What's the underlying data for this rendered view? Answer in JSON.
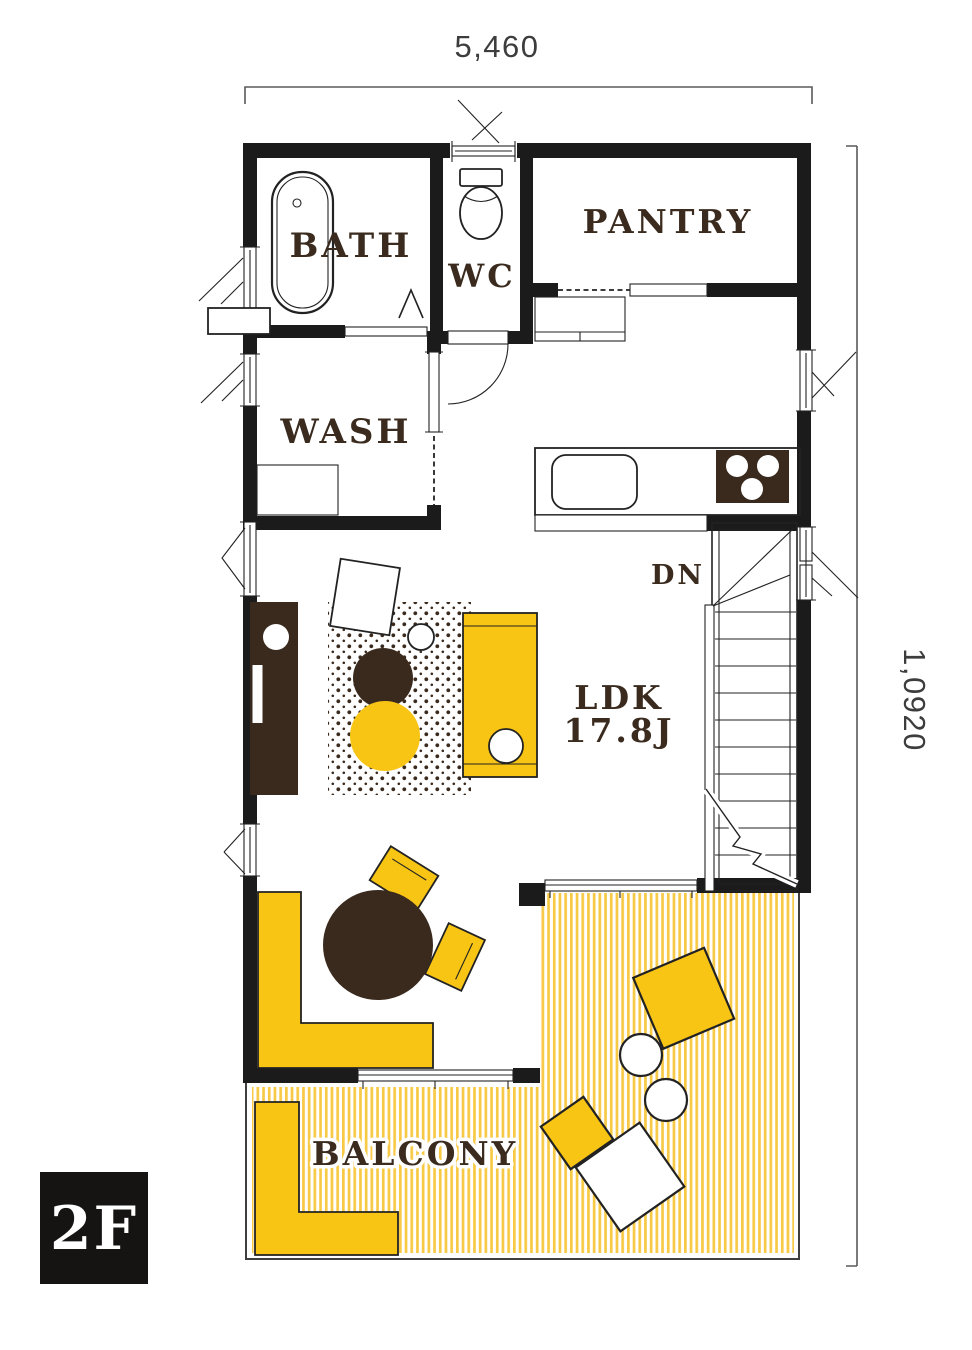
{
  "plan": {
    "floor_badge": "2F",
    "dimensions": {
      "top": "5,460",
      "right": "1,0920"
    },
    "rooms": {
      "bath": "BATH",
      "wc": "WC",
      "pantry": "PANTRY",
      "wash": "WASH",
      "ldk": "LDK",
      "ldk_size": "17.8J",
      "stairs_down": "DN",
      "balcony": "BALCONY"
    },
    "colors": {
      "accent_yellow": "#F8C515",
      "stripe_yellow": "#F7C945",
      "wall_black": "#1B1B1B",
      "dark_brown": "#3A2A1E",
      "label_brown": "#3A2B1E",
      "dim_color": "#3D3D3D"
    }
  }
}
